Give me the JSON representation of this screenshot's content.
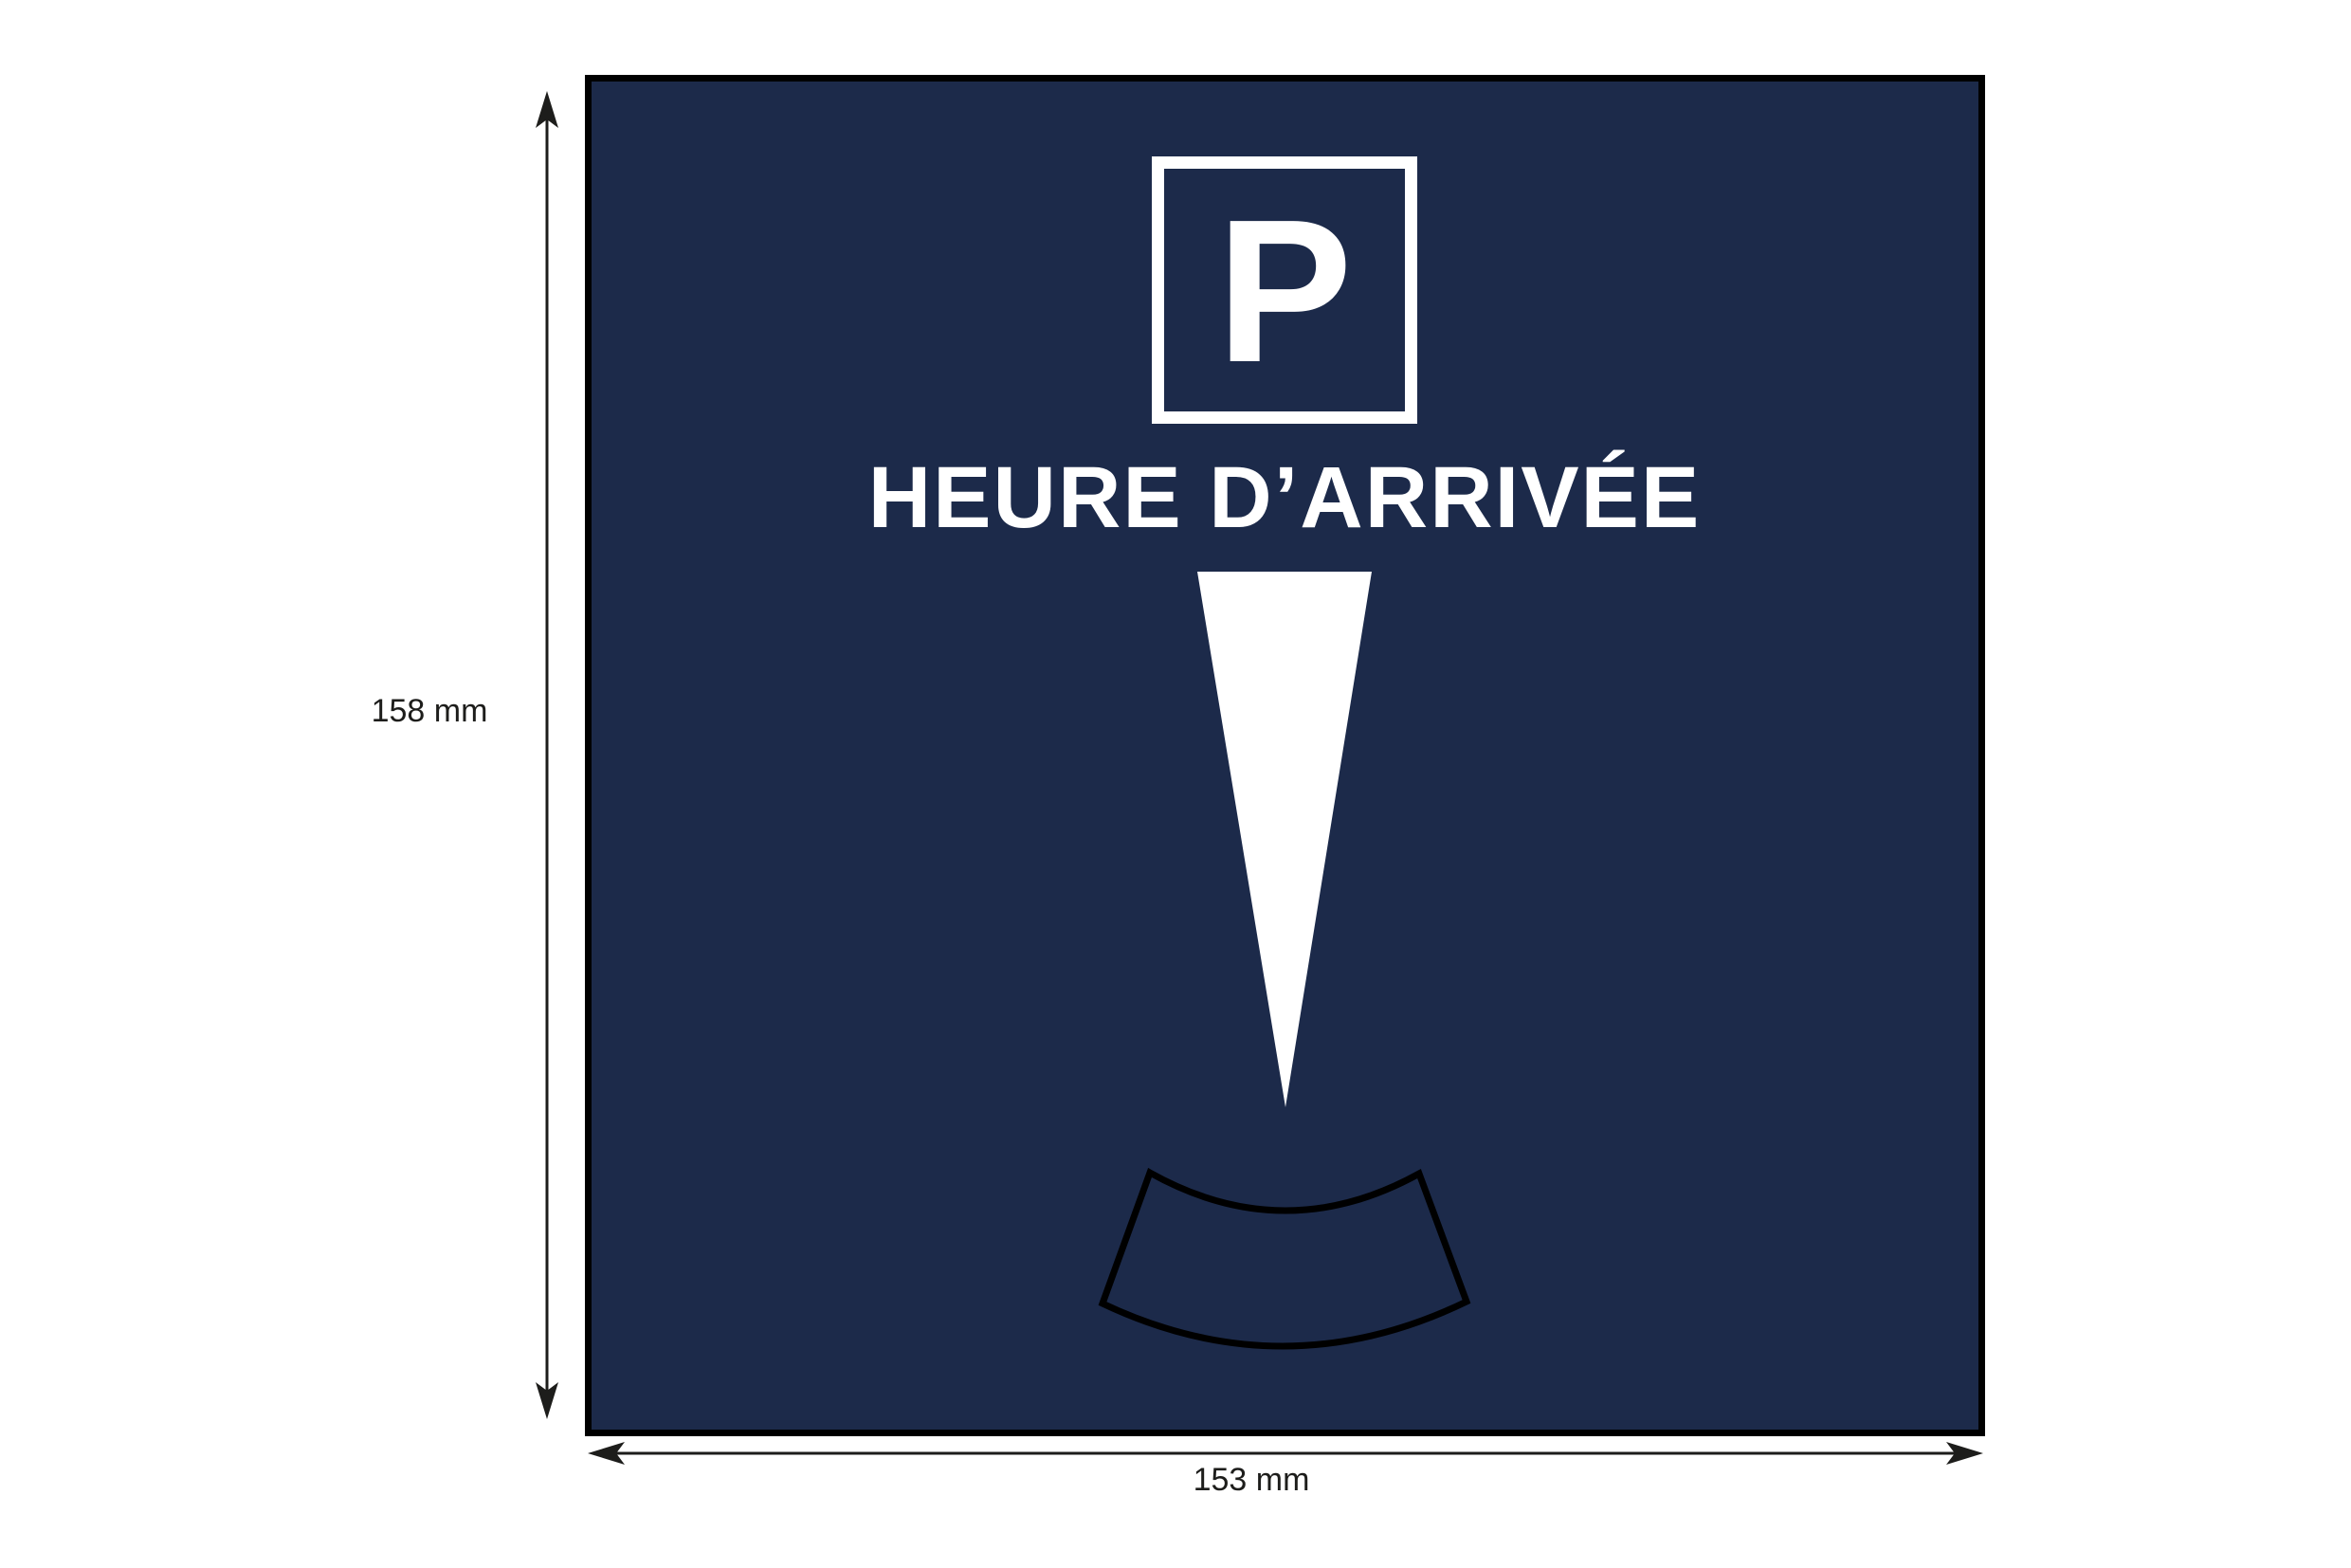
{
  "diagram": {
    "kind": "parking-disc-size-diagram",
    "card": {
      "parking_symbol": "P",
      "title": "HEURE D’ARRIVÉE",
      "background_color": "#1C2A4A",
      "border_color": "#000000",
      "text_color": "#FFFFFF"
    },
    "pointer": {
      "icon": "down-wedge-triangle",
      "color": "#FFFFFF"
    },
    "time_window": {
      "icon": "curved-arc-window-outline",
      "outline_color": "#000000"
    },
    "dimensions": {
      "height_label": "158 mm",
      "width_label": "153 mm",
      "line_color": "#1D1D1B",
      "arrow_icon": "barbed-double-headed-arrow"
    }
  }
}
